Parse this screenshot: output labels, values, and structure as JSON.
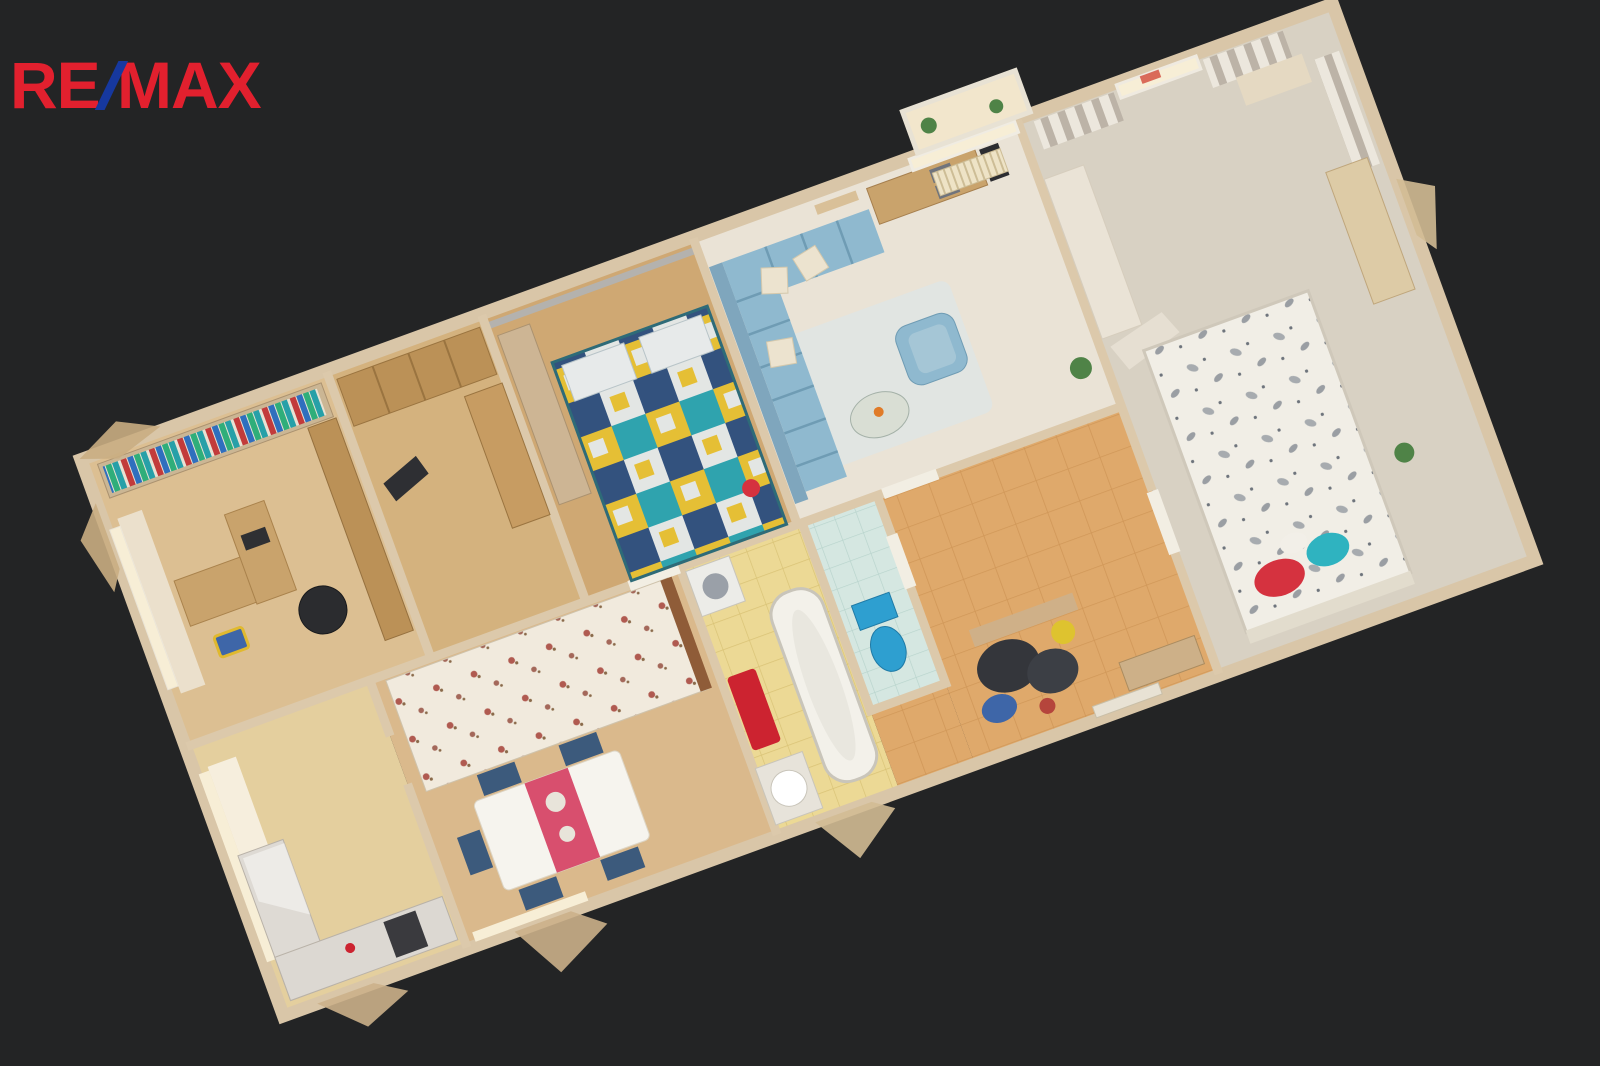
{
  "page": {
    "description": "3D dollhouse top-down cutaway scan of a furnished apartment on dark background",
    "background": "#232425"
  },
  "logo": {
    "re": "RE",
    "slash": "/",
    "max": "MAX",
    "red": "#e2202e",
    "blue": "#16389f"
  },
  "scene": {
    "type": "3d-dollhouse-floorplan",
    "rotation_deg": -20,
    "rooms": [
      {
        "name": "study-office",
        "features": [
          "bookshelf with colorful books",
          "desk with monitor",
          "black office chair",
          "window with curtain",
          "wardrobe"
        ]
      },
      {
        "name": "wardrobe-nook",
        "features": [
          "wooden wardrobes",
          "cabinet"
        ]
      },
      {
        "name": "bedroom-patchwork",
        "features": [
          "double bed with teal-yellow patchwork quilt",
          "wardrobe",
          "gray walls"
        ]
      },
      {
        "name": "living-room",
        "features": [
          "light blue corner sofa with cream pillows",
          "blue armchair",
          "glass coffee table",
          "desk with drawers",
          "radiator",
          "balcony windows",
          "plants",
          "rug"
        ]
      },
      {
        "name": "bedroom-leaf-pattern",
        "features": [
          "bed with white leaf-pattern duvet",
          "red pillow",
          "teal pillow",
          "striped curtains",
          "window",
          "dresser",
          "white wardrobe",
          "carpet"
        ]
      },
      {
        "name": "kitchen",
        "features": [
          "glossy counters",
          "dark appliance",
          "window with net curtain"
        ]
      },
      {
        "name": "dining-bedroom",
        "features": [
          "bed with floral quilt",
          "white dining table with pink runner",
          "dark blue chairs"
        ]
      },
      {
        "name": "bathroom",
        "features": [
          "bathtub",
          "washing machine",
          "sink",
          "red towel",
          "yellow tile floor"
        ]
      },
      {
        "name": "wc",
        "features": [
          "blue toilet",
          "light teal tile floor"
        ]
      },
      {
        "name": "entrance-hall",
        "features": [
          "orange-beige tile floor",
          "coat rack with dark jackets",
          "blue bag",
          "shoe cabinet",
          "doors"
        ]
      }
    ]
  },
  "colors": {
    "wall": "#dcc9ab",
    "wallOuter": "#d9c6a8",
    "doorWhite": "#f2eee3",
    "floorOffice": "#dcbf92",
    "floorNook": "#d4b27e",
    "floorBed1": "#cfa873",
    "floorLiving": "#eae3d6",
    "floorBed2": "#d8d1c3",
    "floorKitchen": "#e4cf9e",
    "floorRoom3": "#dab98c",
    "floorBath": "#ecd995",
    "floorWC": "#d5e7e1",
    "floorHall": "#dfa96b",
    "sofaBlue": "#8fb9cf",
    "quiltTeal": "#2fa3ae",
    "quiltYellow": "#e5bf35",
    "quiltNavy": "#33527e",
    "quiltWhite": "#e3e6e4",
    "runnerPink": "#d84f6e",
    "chairBlue": "#3c5a7c",
    "towelRed": "#cc2330",
    "toiletBlue": "#2e9fd0",
    "pillowRed": "#d5323f",
    "pillowTeal": "#2fb3c0",
    "bedWhite": "#f1eee6",
    "woodDark": "#bb9157",
    "deskWood": "#c9a36c",
    "bookRed": "#c23b3b",
    "bookBlue": "#2f6fbe",
    "bookGreen": "#2fae7a",
    "bookTeal": "#27a0a8",
    "windowGlow": "#f7eed6",
    "radiator": "#eee3c6",
    "coatDark": "#34363b",
    "bagBlue": "#3e66a8",
    "accentYellow": "#dec32f",
    "plantGreen": "#4f8347",
    "rug": "#dfe5e4",
    "chairBlack": "#2b2c2f"
  }
}
